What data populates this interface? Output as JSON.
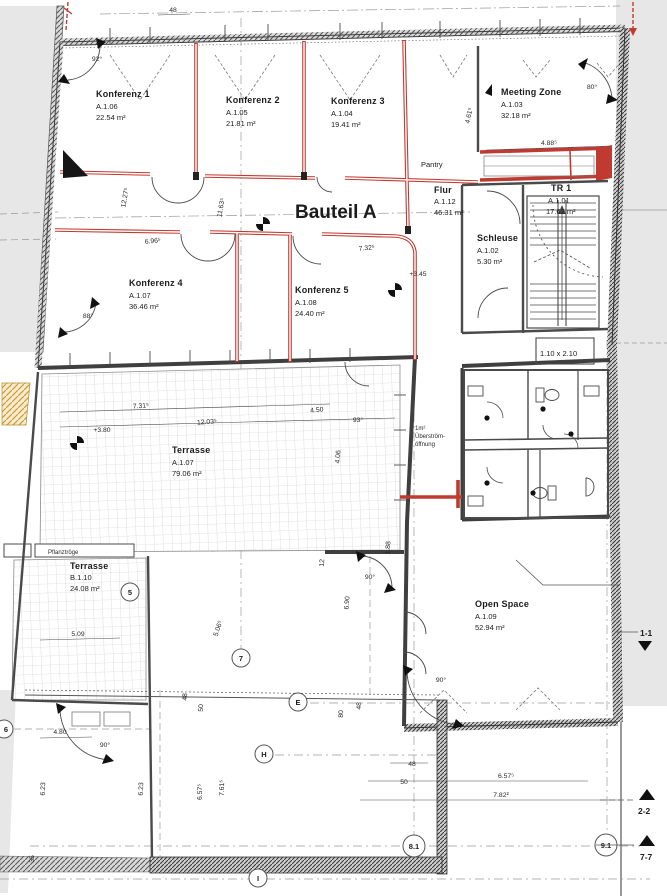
{
  "title": {
    "text": "Bauteil A"
  },
  "rooms": [
    {
      "name": "Konferenz 1",
      "code": "A.1.06",
      "area": "22.54 m²"
    },
    {
      "name": "Konferenz 2",
      "code": "A.1.05",
      "area": "21.81 m²"
    },
    {
      "name": "Konferenz 3",
      "code": "A.1.04",
      "area": "19.41 m²"
    },
    {
      "name": "Meeting Zone",
      "code": "A.1.03",
      "area": "32.18 m²"
    },
    {
      "name": "Flur",
      "code": "A.1.12",
      "area": "46.31 m²"
    },
    {
      "name": "TR 1",
      "code": "A.1.01",
      "area": "17.62 m²"
    },
    {
      "name": "Schleuse",
      "code": "A.1.02",
      "area": "5.30 m²"
    },
    {
      "name": "Konferenz 4",
      "code": "A.1.07",
      "area": "36.46 m²"
    },
    {
      "name": "Konferenz 5",
      "code": "A.1.08",
      "area": "24.40 m²"
    },
    {
      "name": "Terrasse",
      "code": "A.1.07",
      "area": "79.06 m²"
    },
    {
      "name": "Terrasse",
      "code": "B.1.10",
      "area": "24.08 m²"
    },
    {
      "name": "Open Space",
      "code": "A.1.09",
      "area": "52.94 m²"
    }
  ],
  "labels": {
    "pantry": "Pantry",
    "planters": "Pflanztröge",
    "door_size": "1.10 x 2.10",
    "overflow_line1": "1m²",
    "overflow_line2": "Überström-",
    "overflow_line3": "öffnung"
  },
  "grid_markers": [
    "5",
    "6",
    "7",
    "E",
    "H",
    "I",
    "8.1",
    "9.1"
  ],
  "section_markers": [
    "1-1",
    "2-2",
    "7-7"
  ],
  "dims": [
    "48",
    "92°",
    "80°",
    "4.88⁵",
    "4.61⁵",
    "12.27⁵",
    "11.63⁵",
    "6.96⁵",
    "7.32⁵",
    "+3.45",
    "88°",
    "7.31⁵",
    "12.03⁵",
    "+3.80",
    "4.50",
    "93°",
    "4.06",
    "1.88",
    "6.90",
    "90°",
    "5.09",
    "5.06⁵",
    "6.23",
    "4.80",
    "90°",
    "6.57⁵",
    "7.61⁵",
    "48",
    "50",
    "80",
    "48",
    "50",
    "6.57⁵",
    "7.82²",
    "90°",
    "35",
    "6.23",
    "12",
    "48"
  ],
  "colors": {
    "wall": "#3f3f3f",
    "red": "#c03a31",
    "grid": "#999999",
    "zone": "#e7e7e7",
    "accent_orange": "#d49a2a"
  }
}
